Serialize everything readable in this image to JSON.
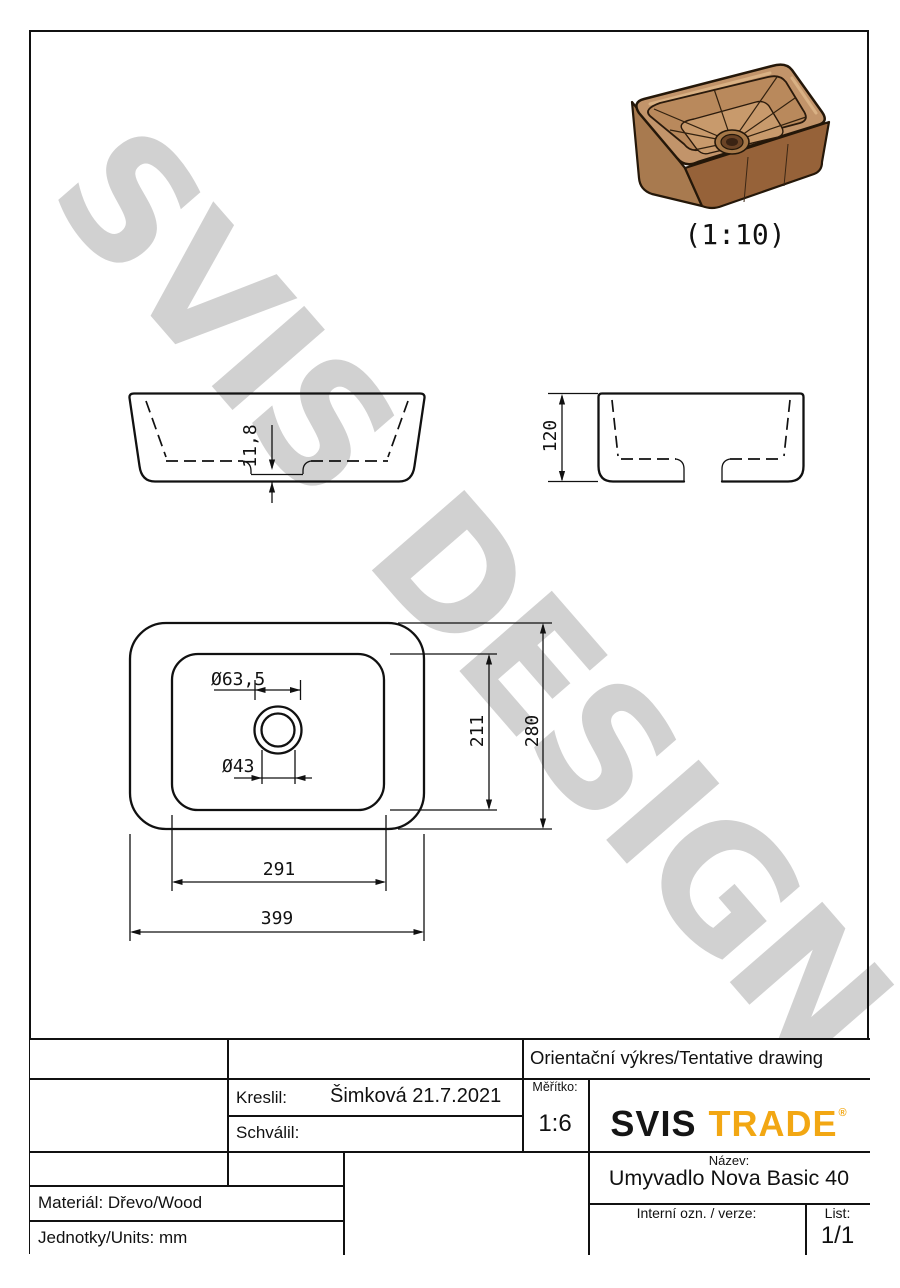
{
  "watermark": {
    "text": "SVIS DESIGN",
    "color": "#c6c6c6"
  },
  "preview": {
    "scale_label": "(1:10)"
  },
  "dims": {
    "recess_depth": "11,8",
    "height": "120",
    "drain_outer": "Ø63,5",
    "drain_inner": "Ø43",
    "inner_depth": "211",
    "outer_depth": "280",
    "inner_width": "291",
    "outer_width": "399"
  },
  "title_block": {
    "tentative": "Orientační výkres/Tentative drawing",
    "drawn_label": "Kreslil:",
    "drawn_value": "Šimková 21.7.2021",
    "approved_label": "Schválil:",
    "scale_label": "Měřítko:",
    "scale_value": "1:6",
    "logo": {
      "part1": "SVIS",
      "part2": "TRADE",
      "registered": "®",
      "accent": "#F2A713"
    },
    "name_label": "Název:",
    "name_value": "Umyvadlo Nova Basic 40",
    "internal_label": "Interní ozn. / verze:",
    "sheet_label": "List:",
    "sheet_value": "1/1",
    "material": "Materiál: Dřevo/Wood",
    "units": "Jednotky/Units: mm"
  }
}
